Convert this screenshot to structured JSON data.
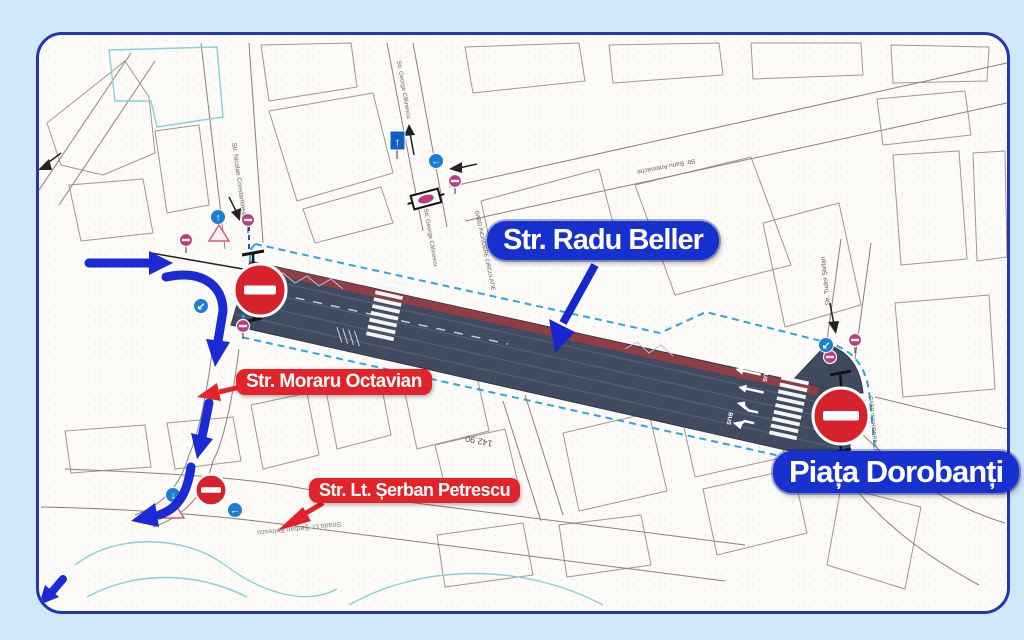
{
  "page": {
    "background": "#cfe9fb"
  },
  "map": {
    "border_color": "#2135b5",
    "background": "#fcfbf8"
  },
  "annotations": {
    "label_blue": "#1731cf",
    "label_red": "#e3232a",
    "blue_labels": [
      {
        "text": "Str. Radu Beller"
      },
      {
        "text": "Piața Dorobanți"
      }
    ],
    "red_labels": [
      {
        "text": "Str. Moraru Octavian"
      },
      {
        "text": "Str. Lt. Șerban Petrescu"
      }
    ]
  },
  "streets": {
    "nicolae_constantinescu": "Str. Nicolae Constantinescu",
    "george_calinescu_north": "Str. George Călinescu",
    "george_calinescu_south": "Str. George Călinescu",
    "banu_antonache": "Str. Banu Antonache",
    "tudor_stefan": "Str. Tudor Ștefan",
    "serban_petrescu_map": "Strada Lt. Șerban Petrescu"
  },
  "markings": {
    "elevation": "142.90",
    "fence_west": "GARD INCHIDERE CIRCULATIE",
    "fence_east": "GARD INCHIDERE CIRCULATIE",
    "bus_1": "BUS",
    "bus_2": "BUS"
  },
  "sign_glyphs": {
    "one_way": "↑",
    "pedestrian_north": "↑",
    "turn_left_down": "↙",
    "turn_left": "←",
    "turn_down_right_side": "↙",
    "down_south": "↓",
    "left_south": "←"
  },
  "legend_colors": {
    "closed_road": "#404b60",
    "bike_stripe": "#8e3e44",
    "fence_dash": "#2da4e4",
    "no_entry": "#d6232b",
    "detour_arrow": "#1b2ad4",
    "sign_magenta": "#bf3c7c",
    "sign_blue": "#1e7fd2"
  }
}
